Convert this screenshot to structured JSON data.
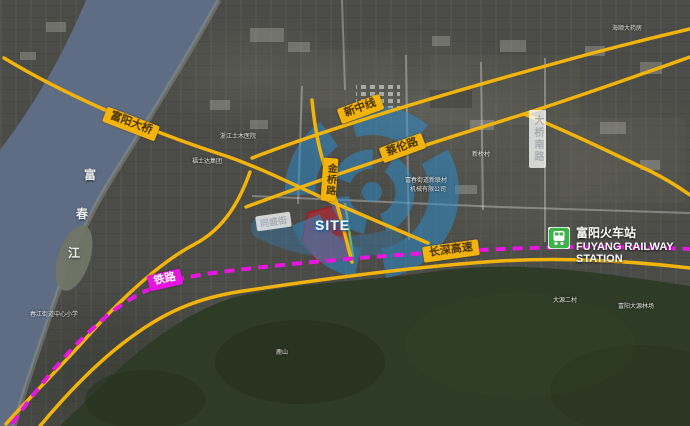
{
  "map": {
    "site": {
      "label": "SITE"
    },
    "river": {
      "name": "富春江",
      "chars": [
        "富",
        "春",
        "江"
      ]
    },
    "roads": {
      "bridge": "富阳大桥",
      "xinzhong_line": "新中线",
      "cailun_road": "蔡伦路",
      "jinqiao_road": "金桥路",
      "daqiao_south_road": "大桥南路",
      "tongsheng_street": "同盛街",
      "railway": "铁路",
      "changshen_expressway": "长深高速"
    },
    "station": {
      "name_cn": "富阳火车站",
      "name_en_line1": "FUYANG RAILWAY",
      "name_en_line2": "STATION",
      "icon": "train-icon"
    },
    "minor_labels": [
      {
        "text": "浙江土木医院"
      },
      {
        "text": "福士达集团"
      },
      {
        "text": "富春街道新联村"
      },
      {
        "text": "机械有限公司"
      },
      {
        "text": "新桥村"
      },
      {
        "text": "海顺大药房"
      },
      {
        "text": "春江街道中心小学"
      },
      {
        "text": "大源二村"
      },
      {
        "text": "富阳大源林场"
      },
      {
        "text": "鹿山"
      }
    ],
    "colors": {
      "road_yellow": "#F2B40B",
      "railway_magenta": "#E616E0",
      "station_green": "#3DB14C",
      "watermark_blue": "#2B8FD2",
      "site_red": "#D0202C",
      "river_blue": "#5E6C84",
      "forest_green": "#2E3B26"
    }
  }
}
